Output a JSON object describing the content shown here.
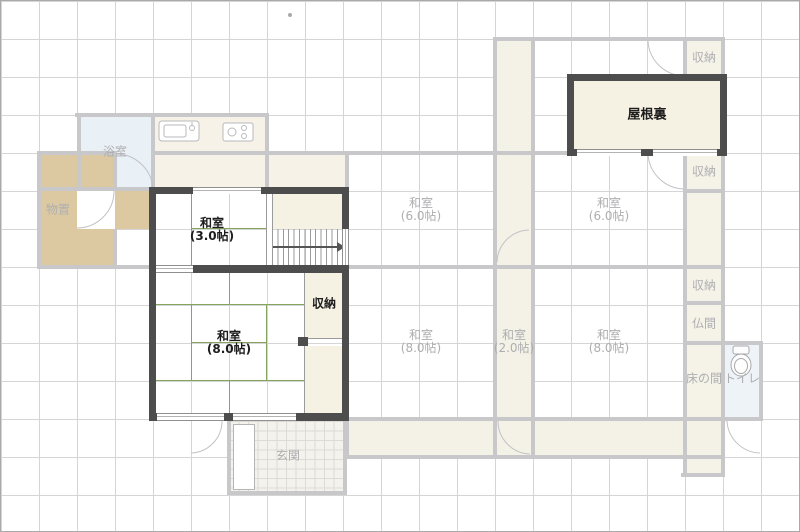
{
  "floorplan": {
    "active_rooms": {
      "washitsu3": {
        "name": "和室",
        "size": "(3.0帖)"
      },
      "washitsu8": {
        "name": "和室",
        "size": "(8.0帖)"
      },
      "closet": {
        "label": "収納"
      },
      "attic": {
        "label": "屋根裏"
      }
    },
    "ghost_rooms": {
      "bath": {
        "label": "浴室"
      },
      "storage": {
        "label": "物置"
      },
      "washitsu6a": {
        "name": "和室",
        "size": "(6.0帖)"
      },
      "washitsu6b": {
        "name": "和室",
        "size": "(6.0帖)"
      },
      "washitsu8a": {
        "name": "和室",
        "size": "(8.0帖)"
      },
      "washitsu2": {
        "name": "和室",
        "size": "(2.0帖)"
      },
      "washitsu8b": {
        "name": "和室",
        "size": "(8.0帖)"
      },
      "closet_tr": {
        "label": "収納"
      },
      "closet_r1": {
        "label": "収納"
      },
      "closet_r2": {
        "label": "収納"
      },
      "butsuma": {
        "label": "仏間"
      },
      "tokonoma": {
        "label": "床の間"
      },
      "toilet": {
        "label": "トイレ"
      },
      "genkan": {
        "label": "玄関"
      }
    },
    "colors": {
      "active_wall": "#4d4d4d",
      "ghost_wall": "#c8c8cb",
      "room_cream": "#f5f1e3",
      "storage_tan": "#dcc9a2",
      "bath_blue": "#eaf1f6",
      "tatami_line": "#85a55e",
      "grid": "#d5d5d5"
    }
  }
}
